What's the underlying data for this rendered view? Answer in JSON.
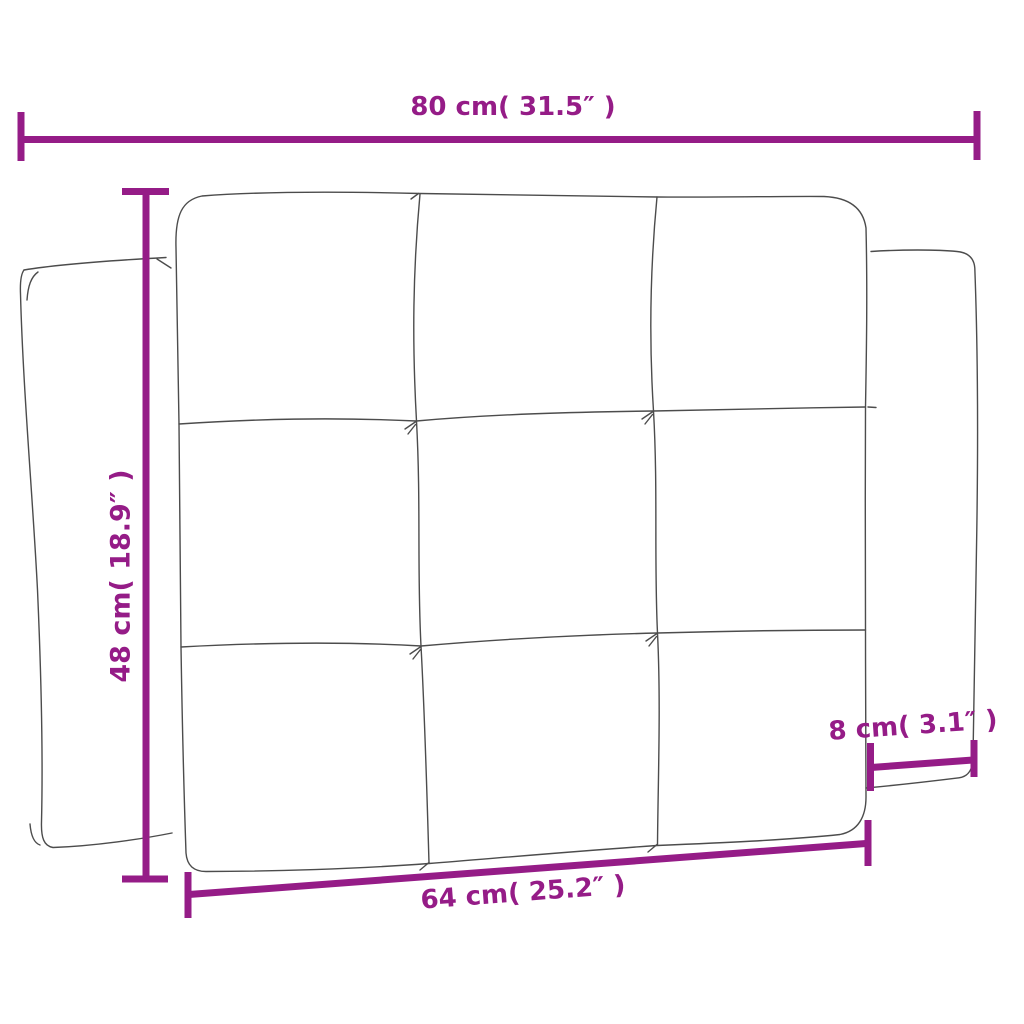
{
  "diagram": {
    "type": "product-dimension-drawing",
    "subject": "tufted-headboard-cushion-with-side-flaps",
    "background_color": "#ffffff",
    "line_art_color": "#4c4c4c",
    "dimension_color": "#951c87",
    "labels": {
      "total_width": "80 cm( 31.5″ )",
      "height": "48 cm( 18.9″ )",
      "flap_depth": "8 cm( 3.1″ )",
      "inner_width": "64 cm( 25.2″ )"
    },
    "measurements": {
      "total_width": {
        "cm": 80,
        "inches": 31.5
      },
      "height": {
        "cm": 48,
        "inches": 18.9
      },
      "flap_depth": {
        "cm": 8,
        "inches": 3.1
      },
      "inner_width": {
        "cm": 64,
        "inches": 25.2
      }
    }
  }
}
